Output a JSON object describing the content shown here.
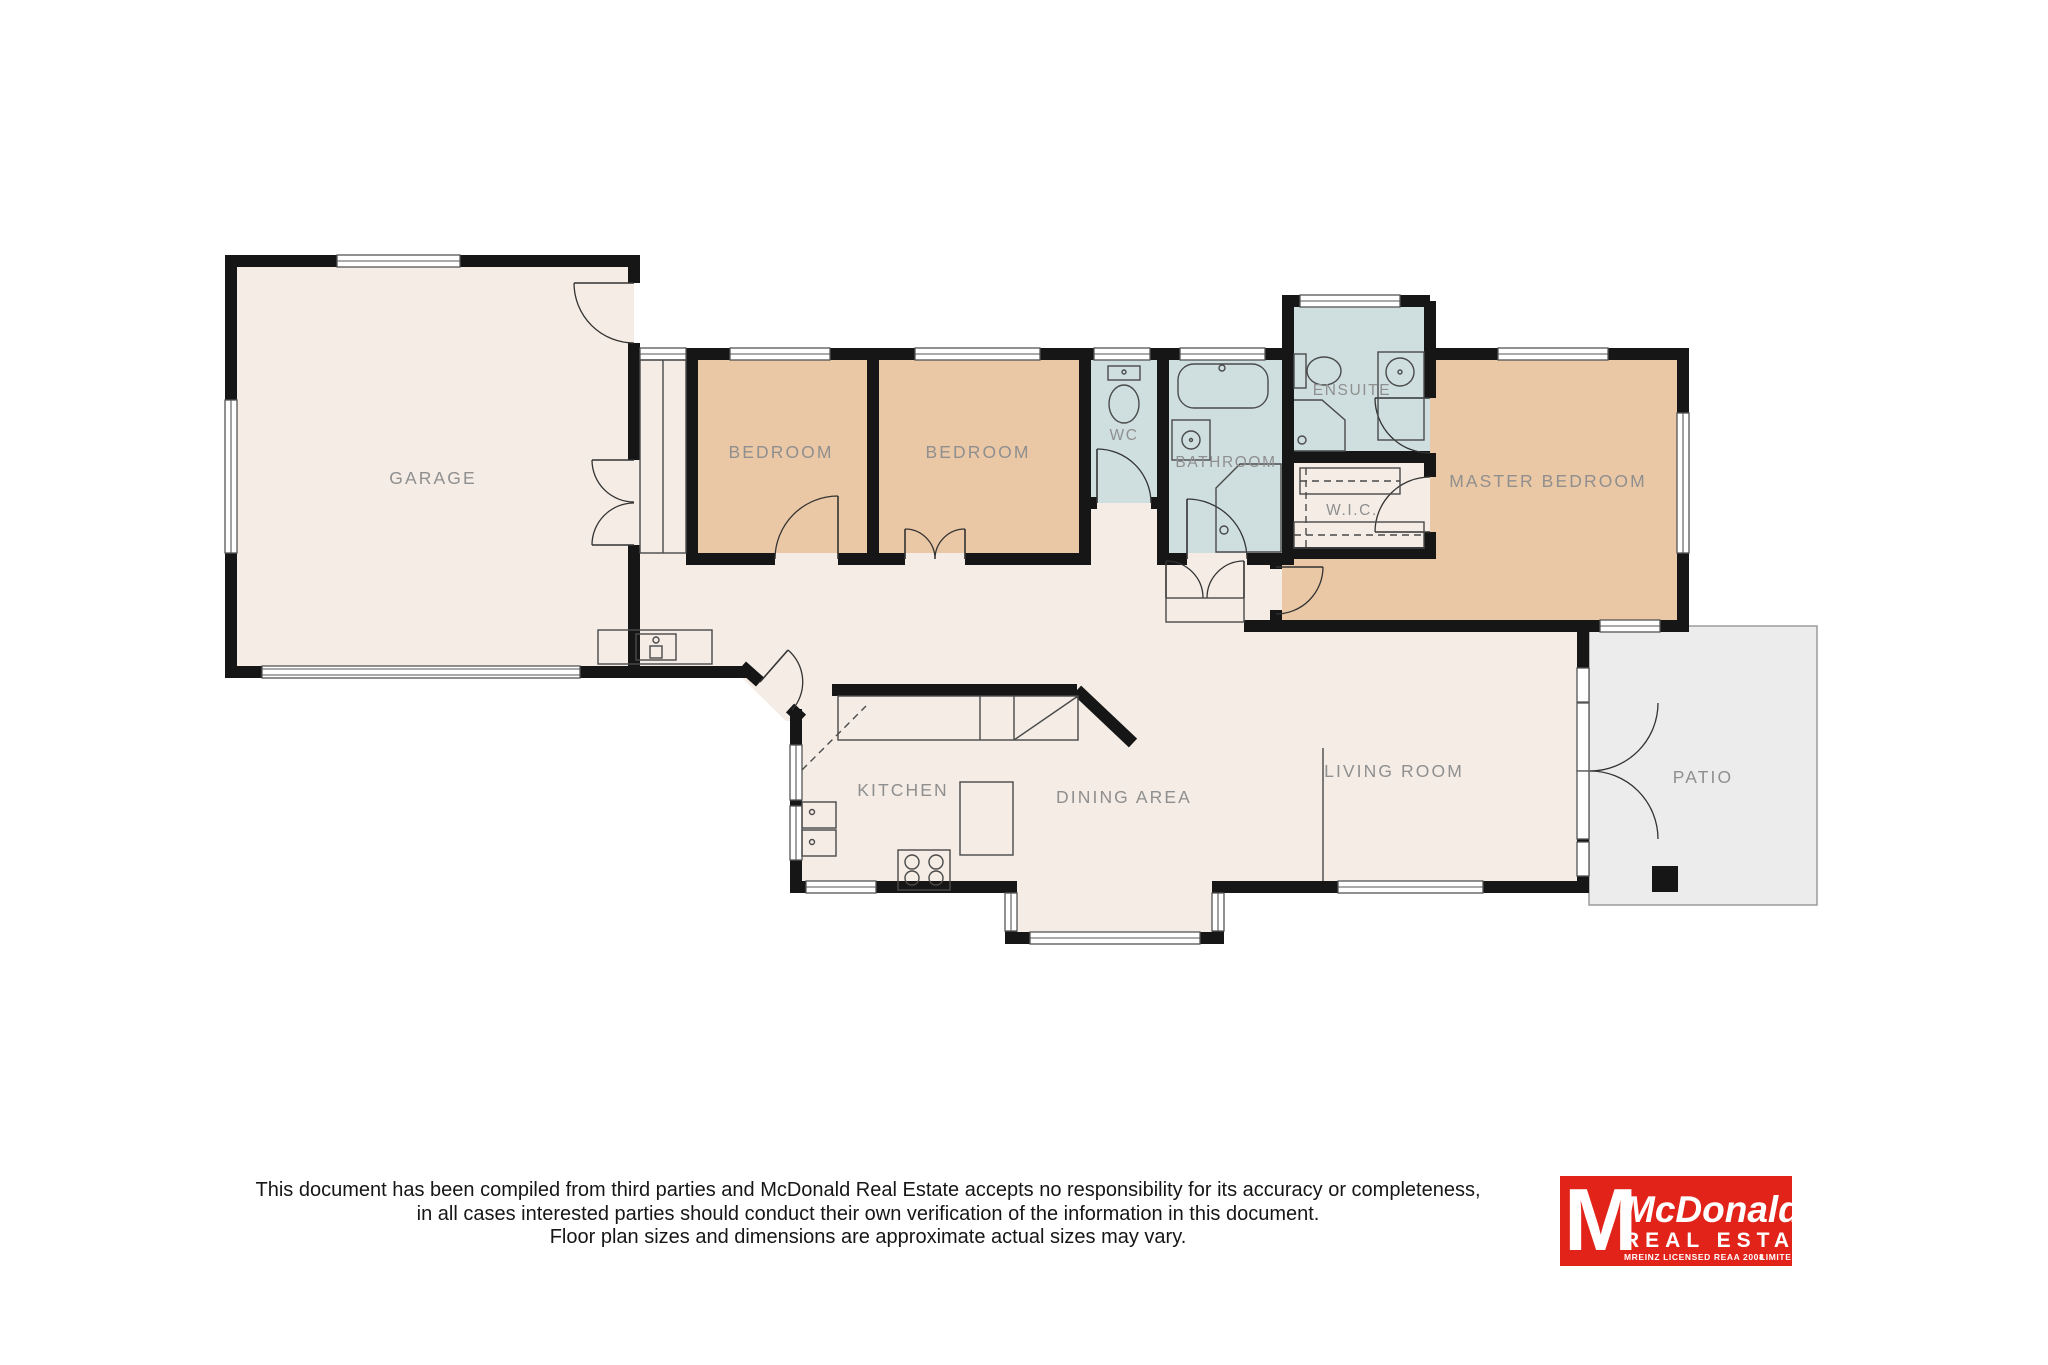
{
  "rooms": {
    "garage": "GARAGE",
    "bedroom1": "BEDROOM",
    "bedroom2": "BEDROOM",
    "wc": "WC",
    "bathroom": "BATHROOM",
    "ensuite": "ENSUITE",
    "wic": "W.I.C.",
    "master": "MASTER BEDROOM",
    "kitchen": "KITCHEN",
    "dining": "DINING AREA",
    "living": "LIVING ROOM",
    "patio": "PATIO"
  },
  "disclaimer": {
    "line1": "This document has been compiled from third parties and McDonald Real Estate accepts no responsibility for its accuracy or completeness,",
    "line2": "in all cases interested parties should conduct their own verification of the information in this document.",
    "line3": "Floor plan sizes and dimensions are approximate actual sizes may vary."
  },
  "logo": {
    "monogram": "M",
    "name": "McDonald",
    "sub": "REAL ESTATE",
    "fine_left": "MREINZ  LICENSED REAA 2008",
    "fine_right": "LIMITED"
  },
  "colors": {
    "wall": "#161616",
    "floor": "#f4ece5",
    "bedroom": "#ebc8a5",
    "wet": "#cfdfe0",
    "patio": "#ececec",
    "label": "#8f8f8f",
    "logored": "#e2231a"
  }
}
